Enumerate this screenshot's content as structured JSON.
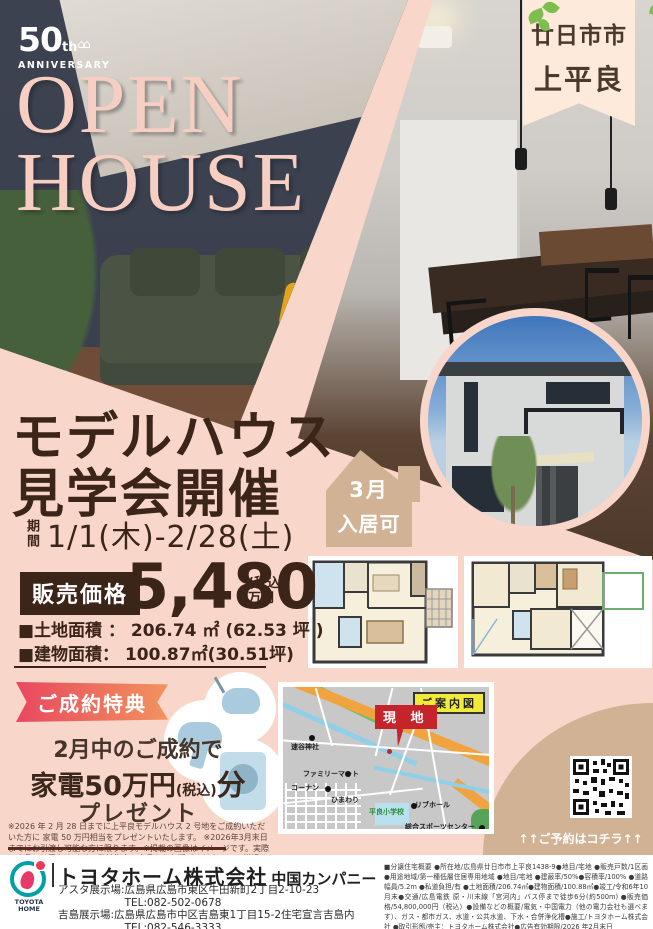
{
  "hero": {
    "anniversary_number": "50",
    "anniversary_suffix": "th",
    "anniversary_houses": "⌂⌂",
    "anniversary_word": "ANNIVERSARY",
    "open_line1": "OPEN",
    "open_line2": "HOUSE",
    "location_line1": "廿日市市",
    "location_line2": "上平良"
  },
  "event": {
    "title_line1": "モデルハウス",
    "title_line2": "見学会開催",
    "period_label": "期間",
    "period_value": "1/1(木)-2/28(土)",
    "badge_line1": "3月",
    "badge_line2": "入居可"
  },
  "price": {
    "label": "販売価格",
    "amount": "5,480",
    "tax_note": "(税込)",
    "unit": "万円",
    "land_area": "■土地面積 ： 206.74 ㎡ (62.53 坪 )",
    "building_area": "■建物面積： 100.87㎡(30.51坪)"
  },
  "promo": {
    "ribbon": "ご成約特典",
    "line1": "2月中のご成約で",
    "line2_a": "家電50万円",
    "line2_b": "(税込)",
    "line2_c": "分",
    "line3": "プレゼント",
    "fine_print": "※2026 年 2 月 28 日までに上平良モデルハウス 2 号地をご成約いただいた方に 家電 50 万円相当をプレゼントいたします。 ※2026年3月末日までにお引渡し可能な方に限ります。※掲載の画像はイメージです。実際の商品とは異な ります。弊社指定の商品からお選びください。 ※詳細は営業担当にご確認ください。"
  },
  "map": {
    "title": "ご案内図",
    "marker": "現 地",
    "landmarks": [
      "速谷神社",
      "ファミリーマート",
      "コーナン",
      "ひまわり",
      "平良小学校",
      "リブホール",
      "総合スポーツセンター"
    ]
  },
  "qr": {
    "caption": "↑↑ご予約はコチラ↑↑"
  },
  "footer": {
    "logo_line1": "TOYOTA",
    "logo_line2": "HOME",
    "company": "トヨタホーム株式会社",
    "division": "中国カンパニー",
    "address1": "アスタ展示場:広島県広島市東区牛田新町2丁目2-10-23",
    "tel1": "TEL:082-502-0678",
    "address2": "吉島展示場:広島県広島市中区吉島東1丁目15-2住宅宣言吉島内",
    "tel2": "TEL:082-546-3333",
    "legal": "■分譲住宅概要 ●所在地/広島県廿日市市上平良1438-9●地目/宅地 ●販売戸数/1区画 ●用途地域/第一種低層住居専用地域 ●地目/宅地 ●建蔽率/50%●容積率/100% ●道路幅員/5.2m ●私道負担/有 ●土地面積/206.74㎡●建物面積/100.88㎡●竣工/令和6年10月末●交通/広島電鉄 原・川末線「宮河内」バス停まで徒歩6分(約500m) ●販売価格/54,800,000円（税込）●設備などの概要/電気・中国電力（他の電力会社も選べます）、ガス・都市ガス、水道・公共水道、下水・合併浄化槽●施工/トヨタホーム株式会社 ●取引形態/売主：トヨタホーム株式会社●広告有効期限/2026 年2月末日"
  }
}
